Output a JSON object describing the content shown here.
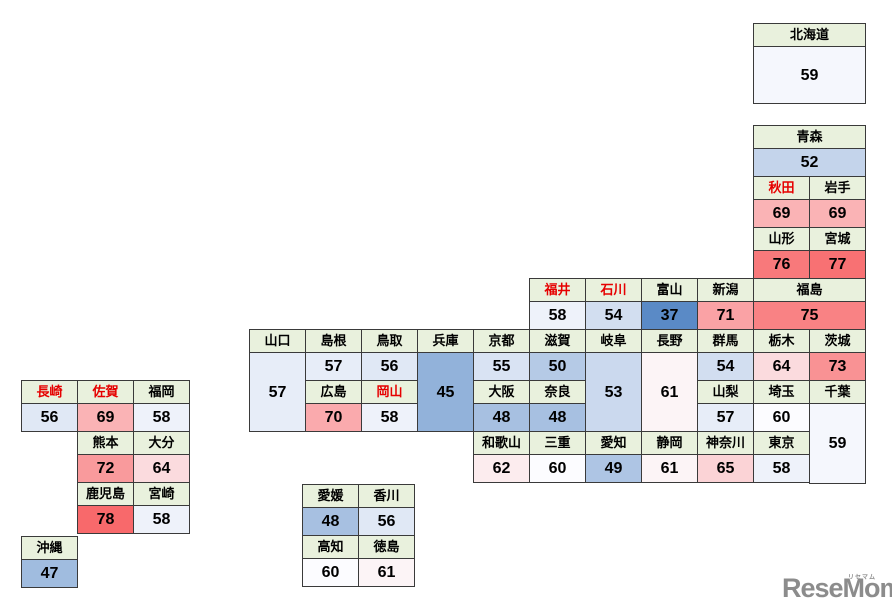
{
  "colors": {
    "page_bg": "#FFFFFF",
    "header_bg": "#E9F1DD",
    "border": "#3A3A3A",
    "red_text": "#E60000",
    "value_text": "#000000",
    "scale_low": "#5A8AC6",
    "scale_mid": "#FCFCFF",
    "scale_high": "#F8696B",
    "logo": "#8C8C8C"
  },
  "logo": {
    "text": "ReseMom.",
    "kana": "リセマム"
  },
  "prefectures": [
    {
      "id": "hokkaido",
      "name": "北海道",
      "value": 59,
      "bg": "#F5F7FD",
      "x": 753,
      "y": 23,
      "w": 112,
      "vh": 57
    },
    {
      "id": "aomori",
      "name": "青森",
      "value": 52,
      "bg": "#C4D4EB",
      "x": 753,
      "y": 125,
      "w": 112
    },
    {
      "id": "akita",
      "name": "秋田",
      "value": 69,
      "bg": "#FAB3B5",
      "x": 753,
      "y": 176,
      "w": 56,
      "red": true
    },
    {
      "id": "iwate",
      "name": "岩手",
      "value": 69,
      "bg": "#FAB3B5",
      "x": 809,
      "y": 176,
      "w": 56
    },
    {
      "id": "yamagata",
      "name": "山形",
      "value": 76,
      "bg": "#F8797B",
      "x": 753,
      "y": 227,
      "w": 56
    },
    {
      "id": "miyagi",
      "name": "宮城",
      "value": 77,
      "bg": "#F87173",
      "x": 809,
      "y": 227,
      "w": 56
    },
    {
      "id": "fukui",
      "name": "福井",
      "value": 58,
      "bg": "#EEF2FA",
      "x": 529,
      "y": 278,
      "w": 56,
      "red": true
    },
    {
      "id": "ishikawa",
      "name": "石川",
      "value": 54,
      "bg": "#D2DEF0",
      "x": 585,
      "y": 278,
      "w": 56,
      "red": true
    },
    {
      "id": "toyama",
      "name": "富山",
      "value": 37,
      "bg": "#5A8AC6",
      "x": 641,
      "y": 278,
      "w": 56
    },
    {
      "id": "niigata",
      "name": "新潟",
      "value": 71,
      "bg": "#FAA2A5",
      "x": 697,
      "y": 278,
      "w": 56
    },
    {
      "id": "fukushima",
      "name": "福島",
      "value": 75,
      "bg": "#F98284",
      "x": 753,
      "y": 278,
      "w": 112
    },
    {
      "id": "yamaguchi",
      "name": "山口",
      "value": 57,
      "bg": "#E7EDF8",
      "x": 249,
      "y": 329,
      "w": 56,
      "vh": 79
    },
    {
      "id": "shimane",
      "name": "島根",
      "value": 57,
      "bg": "#E7EDF8",
      "x": 305,
      "y": 329,
      "w": 56
    },
    {
      "id": "tottori",
      "name": "鳥取",
      "value": 56,
      "bg": "#E0E8F5",
      "x": 361,
      "y": 329,
      "w": 56
    },
    {
      "id": "hyogo",
      "name": "兵庫",
      "value": 45,
      "bg": "#92B2DA",
      "x": 417,
      "y": 329,
      "w": 56,
      "vh": 79
    },
    {
      "id": "kyoto",
      "name": "京都",
      "value": 55,
      "bg": "#D9E3F3",
      "x": 473,
      "y": 329,
      "w": 56
    },
    {
      "id": "shiga",
      "name": "滋賀",
      "value": 50,
      "bg": "#B5CAE6",
      "x": 529,
      "y": 329,
      "w": 56
    },
    {
      "id": "gifu",
      "name": "岐阜",
      "value": 53,
      "bg": "#CBD9EE",
      "x": 585,
      "y": 329,
      "w": 56,
      "vh": 79
    },
    {
      "id": "nagano",
      "name": "長野",
      "value": 61,
      "bg": "#FCF4F6",
      "x": 641,
      "y": 329,
      "w": 56,
      "vh": 79
    },
    {
      "id": "gunma",
      "name": "群馬",
      "value": 54,
      "bg": "#D2DEF0",
      "x": 697,
      "y": 329,
      "w": 56
    },
    {
      "id": "tochigi",
      "name": "栃木",
      "value": 64,
      "bg": "#FBDBDE",
      "x": 753,
      "y": 329,
      "w": 56
    },
    {
      "id": "ibaraki",
      "name": "茨城",
      "value": 73,
      "bg": "#F99294",
      "x": 809,
      "y": 329,
      "w": 56
    },
    {
      "id": "hiroshima",
      "name": "広島",
      "value": 70,
      "bg": "#FAAAAD",
      "x": 305,
      "y": 380,
      "w": 56
    },
    {
      "id": "okayama",
      "name": "岡山",
      "value": 58,
      "bg": "#EEF2FA",
      "x": 361,
      "y": 380,
      "w": 56,
      "red": true
    },
    {
      "id": "osaka",
      "name": "大阪",
      "value": 48,
      "bg": "#A7C0E1",
      "x": 473,
      "y": 380,
      "w": 56
    },
    {
      "id": "nara",
      "name": "奈良",
      "value": 48,
      "bg": "#A7C0E1",
      "x": 529,
      "y": 380,
      "w": 56
    },
    {
      "id": "yamanashi",
      "name": "山梨",
      "value": 57,
      "bg": "#E7EDF8",
      "x": 697,
      "y": 380,
      "w": 56
    },
    {
      "id": "saitama",
      "name": "埼玉",
      "value": 60,
      "bg": "#FCFCFF",
      "x": 753,
      "y": 380,
      "w": 56
    },
    {
      "id": "chiba",
      "name": "千葉",
      "value": 59,
      "bg": "#F5F7FD",
      "x": 809,
      "y": 380,
      "w": 56,
      "vh": 80
    },
    {
      "id": "wakayama",
      "name": "和歌山",
      "value": 62,
      "bg": "#FCECEE",
      "x": 473,
      "y": 431,
      "w": 56
    },
    {
      "id": "mie",
      "name": "三重",
      "value": 60,
      "bg": "#FCFCFF",
      "x": 529,
      "y": 431,
      "w": 56
    },
    {
      "id": "aichi",
      "name": "愛知",
      "value": 49,
      "bg": "#AEC5E4",
      "x": 585,
      "y": 431,
      "w": 56
    },
    {
      "id": "shizuoka",
      "name": "静岡",
      "value": 61,
      "bg": "#FCF4F6",
      "x": 641,
      "y": 431,
      "w": 56
    },
    {
      "id": "kanagawa",
      "name": "神奈川",
      "value": 65,
      "bg": "#FBD3D6",
      "x": 697,
      "y": 431,
      "w": 56
    },
    {
      "id": "tokyo",
      "name": "東京",
      "value": 58,
      "bg": "#EEF2FA",
      "x": 753,
      "y": 431,
      "w": 56
    },
    {
      "id": "nagasaki",
      "name": "長崎",
      "value": 56,
      "bg": "#E0E8F5",
      "x": 21,
      "y": 380,
      "w": 56,
      "red": true
    },
    {
      "id": "saga",
      "name": "佐賀",
      "value": 69,
      "bg": "#FAB3B5",
      "x": 77,
      "y": 380,
      "w": 56,
      "red": true
    },
    {
      "id": "fukuoka",
      "name": "福岡",
      "value": 58,
      "bg": "#EEF2FA",
      "x": 133,
      "y": 380,
      "w": 56
    },
    {
      "id": "kumamoto",
      "name": "熊本",
      "value": 72,
      "bg": "#F99A9C",
      "x": 77,
      "y": 431,
      "w": 56
    },
    {
      "id": "oita",
      "name": "大分",
      "value": 64,
      "bg": "#FBDBDE",
      "x": 133,
      "y": 431,
      "w": 56
    },
    {
      "id": "kagoshima",
      "name": "鹿児島",
      "value": 78,
      "bg": "#F8696B",
      "x": 77,
      "y": 482,
      "w": 56
    },
    {
      "id": "miyazaki",
      "name": "宮崎",
      "value": 58,
      "bg": "#EEF2FA",
      "x": 133,
      "y": 482,
      "w": 56
    },
    {
      "id": "okinawa",
      "name": "沖縄",
      "value": 47,
      "bg": "#A0BCDF",
      "x": 21,
      "y": 536,
      "w": 56
    },
    {
      "id": "ehime",
      "name": "愛媛",
      "value": 48,
      "bg": "#A7C0E1",
      "x": 302,
      "y": 484,
      "w": 56
    },
    {
      "id": "kagawa",
      "name": "香川",
      "value": 56,
      "bg": "#E0E8F5",
      "x": 358,
      "y": 484,
      "w": 56
    },
    {
      "id": "kochi",
      "name": "高知",
      "value": 60,
      "bg": "#FCFCFF",
      "x": 302,
      "y": 535,
      "w": 56
    },
    {
      "id": "tokushima",
      "name": "徳島",
      "value": 61,
      "bg": "#FCF4F6",
      "x": 358,
      "y": 535,
      "w": 56
    }
  ]
}
